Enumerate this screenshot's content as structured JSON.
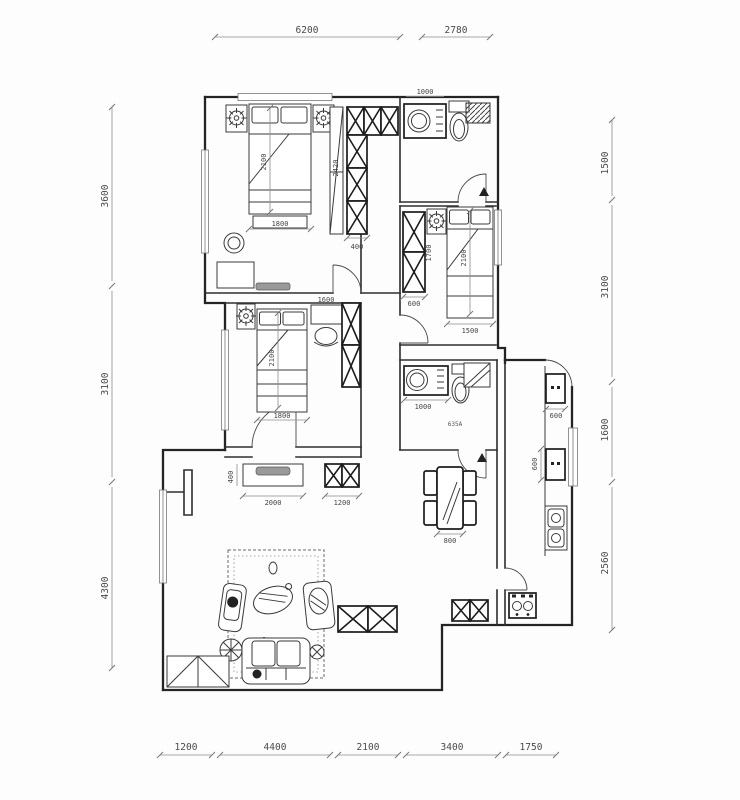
{
  "dimensions": {
    "top": [
      "6200",
      "2780"
    ],
    "left": [
      "3600",
      "3100",
      "4300"
    ],
    "right": [
      "1500",
      "3100",
      "1600",
      "2560"
    ],
    "bottom": [
      "1200",
      "4400",
      "2100",
      "3400",
      "1750"
    ]
  },
  "interior": {
    "master_bed_length": "2100",
    "master_bed_width": "1800",
    "master_closet_height": "2420",
    "master_closet_width": "400",
    "bath_top_vanity_width": "1000",
    "bedroom_right_wardrobe_width": "600",
    "bedroom_right_wardrobe_length": "1700",
    "bedroom_right_bed_length": "2100",
    "bedroom_right_bed_width": "1500",
    "bedroom_left_desk_width": "1600",
    "bedroom_left_bed_length": "2100",
    "bedroom_left_bed_width": "1800",
    "bath_mid_vanity_width": "1000",
    "bath_mid_note": "635A",
    "dining_table_width": "800",
    "kitchen_unit_top_width": "600",
    "kitchen_unit_mid_width": "600",
    "tv_cabinet_width": "2000",
    "tv_cabinet_depth": "400",
    "shoe_cabinet_width": "1200"
  }
}
